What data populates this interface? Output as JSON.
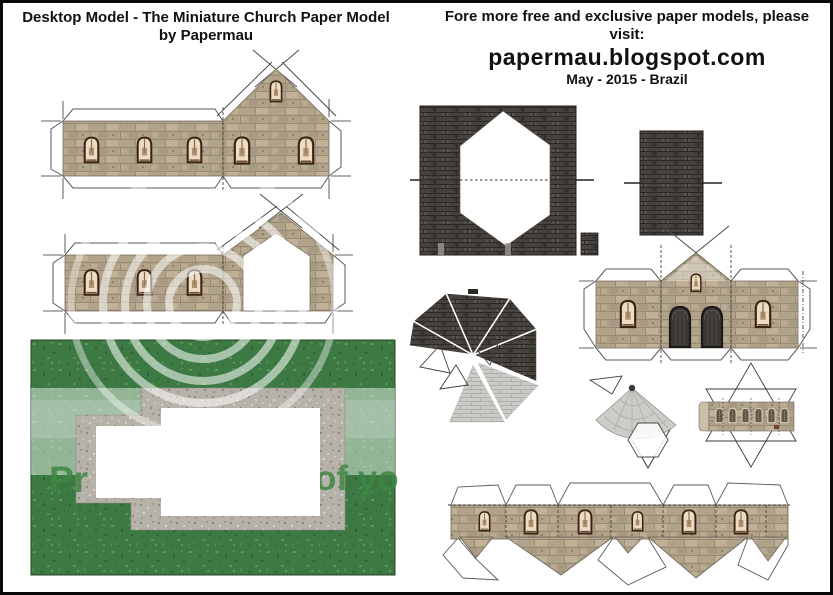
{
  "header_left": {
    "line1": "Desktop Model - The Miniature Church Paper Model",
    "line2": "by Papermau"
  },
  "header_right": {
    "line1": "Fore more free and exclusive paper models, please visit:",
    "line2": "papermau.blogspot.com",
    "line3": "May - 2015 - Brazil"
  },
  "watermark": {
    "left_fragment": "Pr",
    "right_fragment": "of yo",
    "text_color": "#3e8742"
  },
  "colors": {
    "stone": "#b1a28a",
    "stone_line": "#998b73",
    "roof_dark": "#47423d",
    "roof_light": "#cbcac6",
    "grass": "#3d7a43",
    "path": "#b6b2aa",
    "window_frame": "#3b2317",
    "window_glass": "#ecdcc3",
    "door": "#3a3734",
    "page_border": "#0a0a0a"
  }
}
